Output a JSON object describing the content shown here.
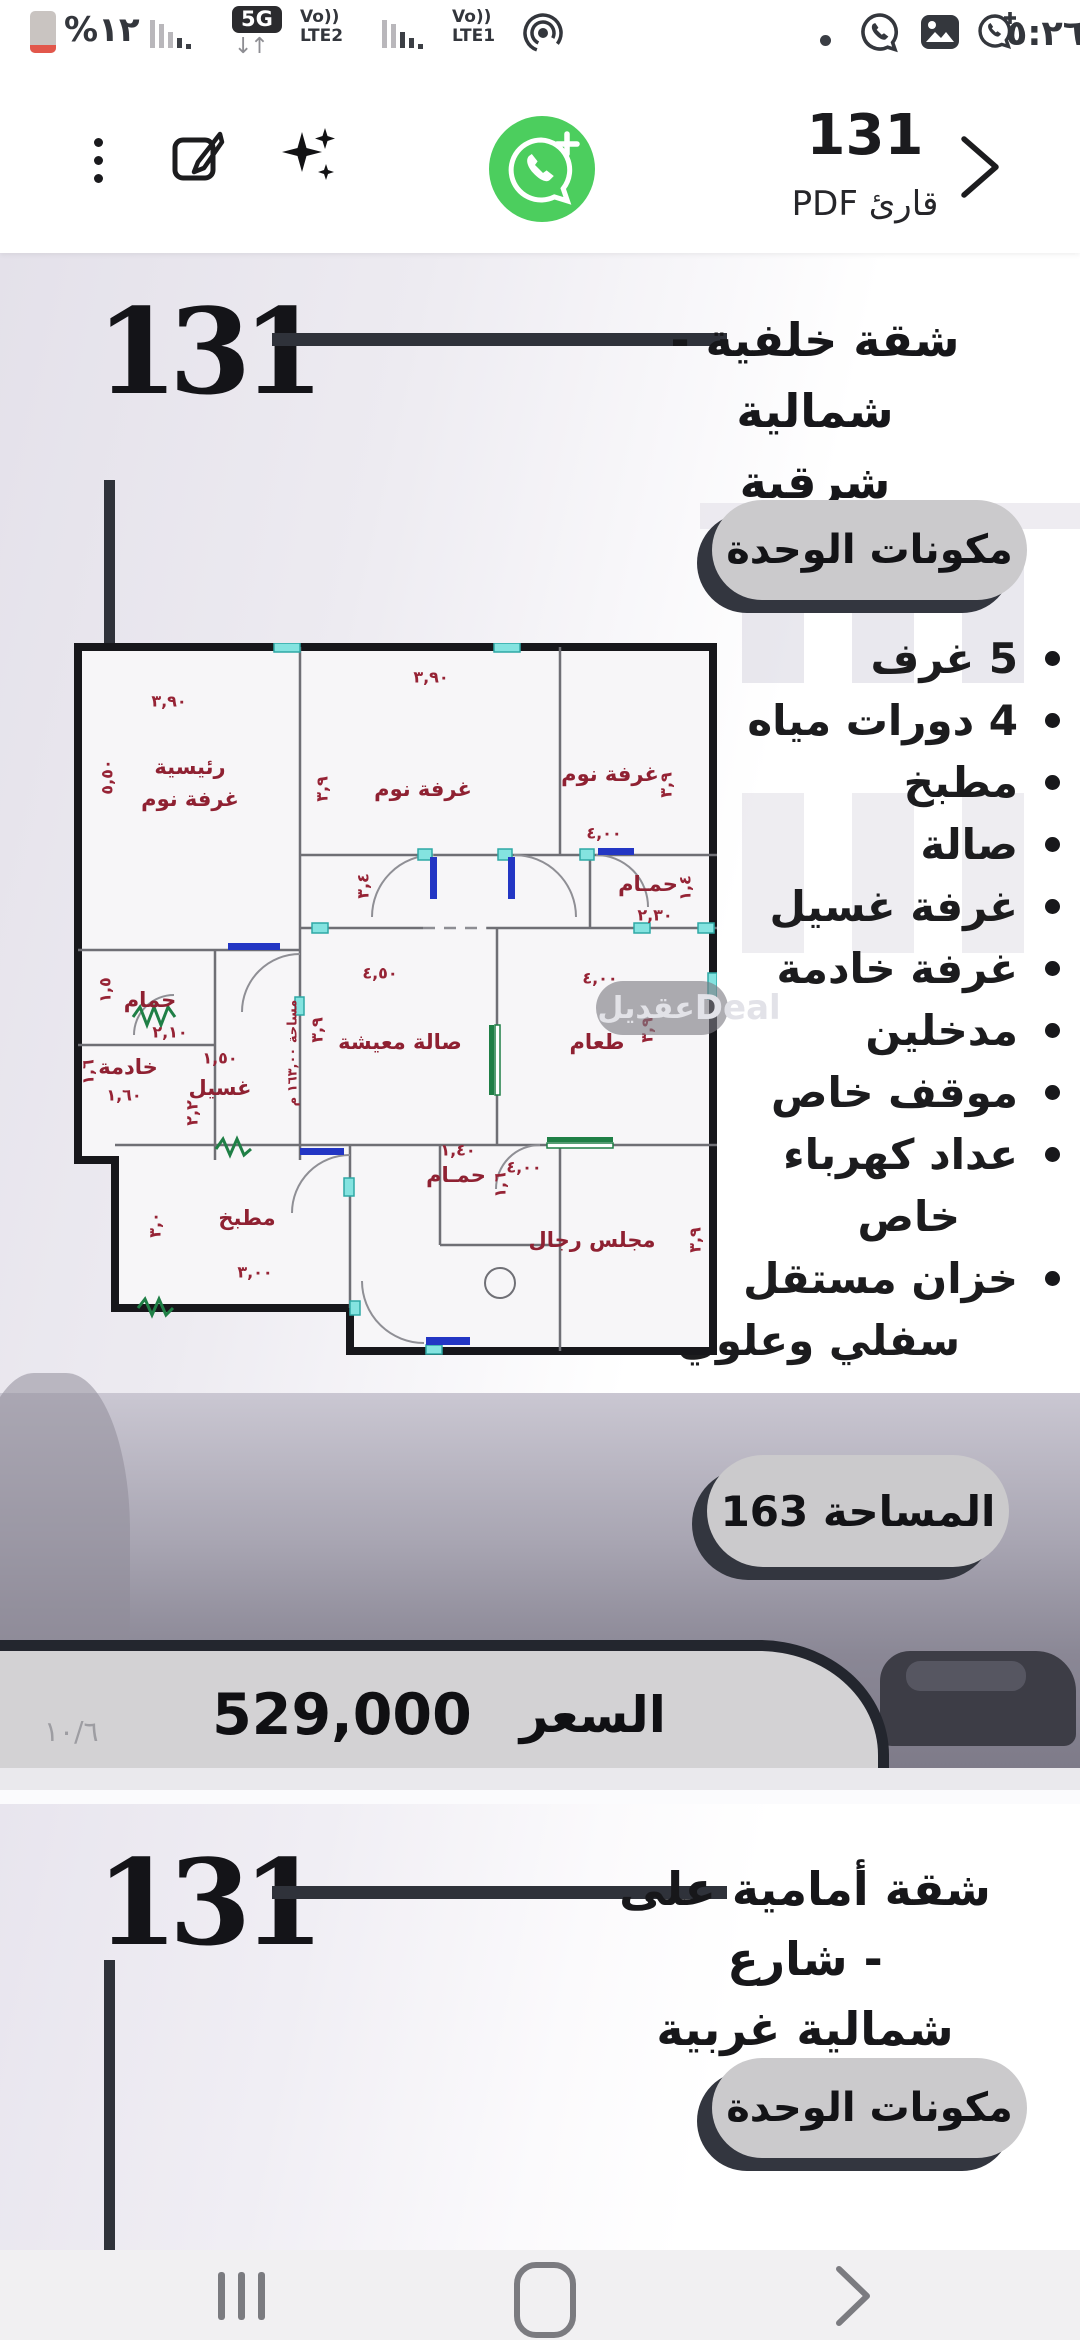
{
  "status_bar": {
    "battery_percent": "%١٢",
    "badge_5g": "5G",
    "arrows": "↓↑",
    "net1_vo": "Vo))",
    "net1_lte": "LTE2",
    "net2_vo": "Vo))",
    "net2_lte": "LTE1",
    "time": "٥:٢٦"
  },
  "toolbar": {
    "title": "131",
    "subtitle": "قارئ PDF"
  },
  "page1": {
    "big_number": "131",
    "title_line1": "شقة خلفية - شمالية",
    "title_line2": "شرقية",
    "components_button": "مكونات الوحدة",
    "features": [
      {
        "text": "5 غرف"
      },
      {
        "text": "4 دورات مياه"
      },
      {
        "text": "مطبخ"
      },
      {
        "text": "صالة"
      },
      {
        "text": "غرفة غسيل"
      },
      {
        "text": "غرفة خادمة"
      },
      {
        "text": "مدخلين"
      },
      {
        "text": "موقف خاص"
      },
      {
        "text": "عداد كهرباء",
        "text2": "خاص"
      },
      {
        "text": "خزان مستقل",
        "text2": "سفلي وعلوي"
      }
    ],
    "area_button": "المساحة 163",
    "price_label": "السعر",
    "price_value": "529,000",
    "page_indicator": "١٠/٦"
  },
  "floorplan": {
    "watermark_ar": "عقديل",
    "watermark_en": "Deal",
    "labels": {
      "master1": "رئيسية",
      "master2": "غرفة نوم",
      "bed2": "غرفة نوم",
      "bed3": "غرفة نوم",
      "bath_right": "حمـام",
      "bath_left": "حمام",
      "maid": "خادمة",
      "laundry": "غسيل",
      "kitchen": "مطبخ",
      "living": "صالة معيشة",
      "dining": "طعام",
      "bath_mid": "حمـام",
      "majlis": "مجلس رجال",
      "area_note": "مساحة ١٦٣,٠٠ م"
    },
    "dims": [
      "٣,٩٠",
      "٥,٥٠",
      "٣,٩٠",
      "٣,٩",
      "٤,٠٠",
      "٣,٩",
      "٣,٤",
      "٢,٣٠",
      "١,٤",
      "٢,١٠",
      "١,٥",
      "١,٦٠",
      "١,٦",
      "١,٥٠",
      "٢,٢",
      "٣,٠٠",
      "٣,٠",
      "٤,٥٠",
      "٣,٩",
      "٤,٠٠",
      "٣,٩",
      "١,٤٠",
      "١,٦",
      "٤,٠٠",
      "٣,٩"
    ]
  },
  "page2": {
    "big_number": "131",
    "title_line1": "شقة أمامية على شارع -",
    "title_line2": "شمالية غربية",
    "components_button": "مكونات الوحدة"
  },
  "colors": {
    "accent_green": "#4cce5e",
    "pill_gray": "#cbcacc",
    "shadow_dark": "#33363f",
    "banner_gray": "#d3d2d4",
    "maroon": "#8f2132"
  }
}
